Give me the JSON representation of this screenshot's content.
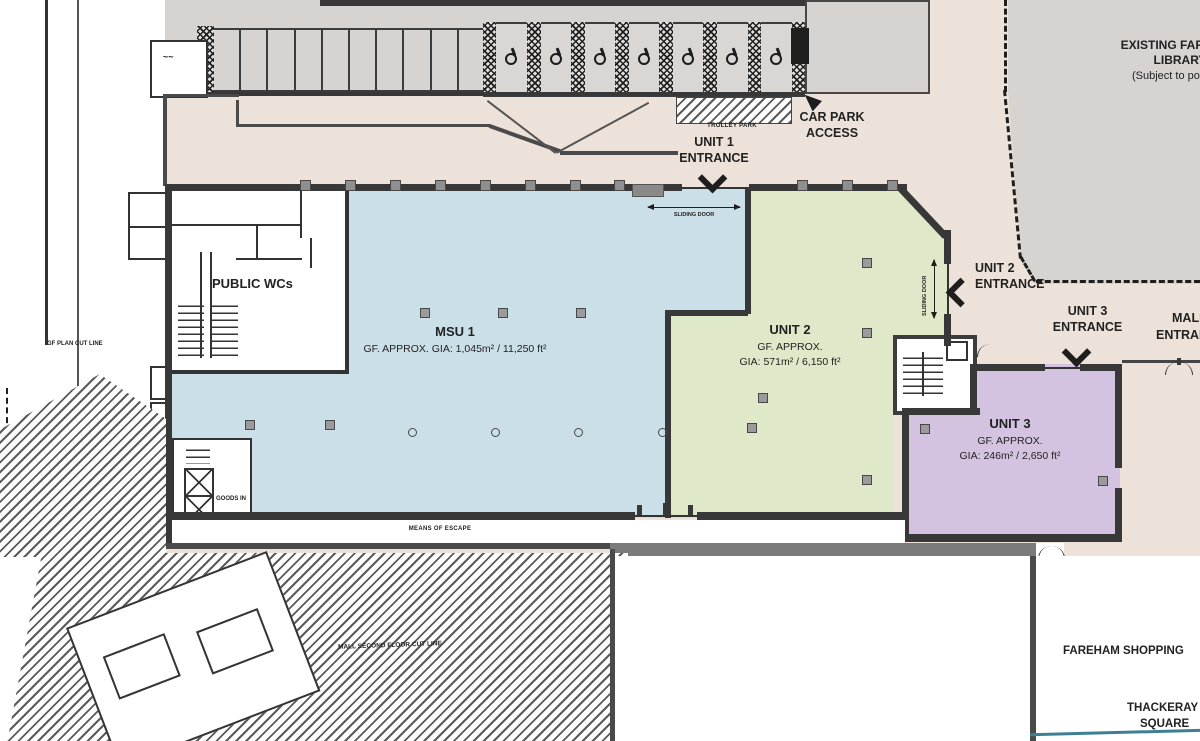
{
  "colors": {
    "background": "#EDE2DA",
    "road": "#FFFFFF",
    "building_gray": "#D6D3D1",
    "msu1_fill": "#CBDFE8",
    "unit2_fill": "#DFE8C8",
    "unit3_fill": "#D4C3E0",
    "wall_dark": "#383838",
    "wall_gray": "#7B7B7B",
    "accent_teal": "#3E7F95"
  },
  "units": {
    "msu1": {
      "name": "MSU 1",
      "area": "GF. APPROX. GIA: 1,045m² / 11,250 ft²"
    },
    "unit2": {
      "name": "UNIT 2",
      "approx": "GF. APPROX.",
      "area": "GIA: 571m² / 6,150 ft²"
    },
    "unit3": {
      "name": "UNIT 3",
      "approx": "GF. APPROX.",
      "area": "GIA: 246m² / 2,650 ft²"
    }
  },
  "entrances": {
    "unit1": {
      "line1": "UNIT 1",
      "line2": "ENTRANCE"
    },
    "unit2": {
      "line1": "UNIT 2",
      "line2": "ENTRANCE"
    },
    "unit3": {
      "line1": "UNIT 3",
      "line2": "ENTRANCE"
    },
    "mall": {
      "line1": "MALL",
      "line2": "ENTRANCE"
    },
    "car_park": {
      "line1": "CAR PARK",
      "line2": "ACCESS"
    }
  },
  "labels": {
    "library": {
      "line1": "EXISTING FAREHAM",
      "line2": "LIBRARY",
      "line3": "(Subject to possible"
    },
    "trolley_park": "TROLLEY PARK",
    "public_wcs": "PUBLIC WCs",
    "means_of_escape": "MEANS OF ESCAPE",
    "sliding_door": "SLIDING DOOR",
    "goods_in": "GOODS IN",
    "gf_plan_cut_line": "GF PLAN CUT LINE",
    "hatched_area_note": "MALL SECOND FLOOR CUT LINE",
    "fareham_shopping": "FAREHAM SHOPPING",
    "thackeray": {
      "line1": "THACKERAY",
      "line2": "SQUARE"
    }
  },
  "structures": {
    "parking_bays": 10,
    "trolley_bays": 7,
    "wall_ticks_x": [
      300,
      345,
      390,
      435,
      480,
      525,
      570,
      614,
      797,
      842,
      887
    ],
    "columns_squares": [
      [
        420,
        308
      ],
      [
        498,
        308
      ],
      [
        576,
        308
      ],
      [
        245,
        420
      ],
      [
        325,
        420
      ],
      [
        747,
        423
      ],
      [
        758,
        393
      ],
      [
        862,
        258
      ],
      [
        862,
        328
      ],
      [
        862,
        475
      ],
      [
        920,
        424
      ],
      [
        1098,
        476
      ]
    ],
    "columns_circles": [
      [
        408,
        428
      ],
      [
        491,
        428
      ],
      [
        574,
        428
      ],
      [
        658,
        428
      ]
    ]
  }
}
